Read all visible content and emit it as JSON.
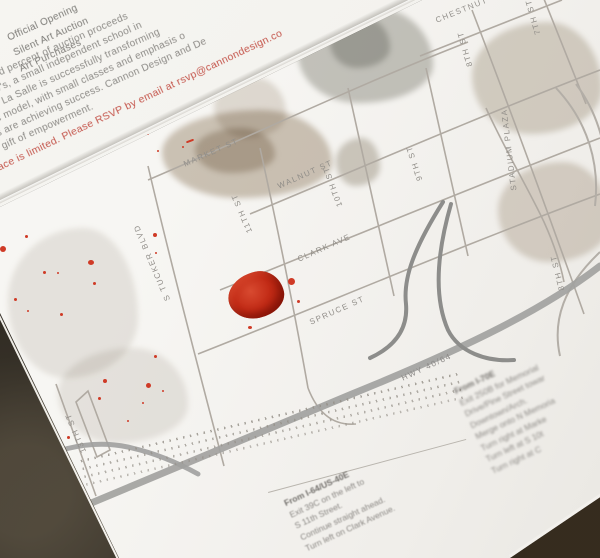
{
  "invitation": {
    "headers": [
      "Official Opening",
      "Silent Art Auction",
      "Art Purchases"
    ],
    "body_lines": [
      "ed percent of auction proceeds",
      "w's, a small independent school in",
      "e La Salle is successfully transforming",
      "ic model, with small classes and emphasis o",
      "ts are achieving success. Cannon Design and De",
      "e gift of empowerment."
    ],
    "rsvp_line": "ace is limited. Please RSVP by email at rsvp@cannondesign.co"
  },
  "map": {
    "street_labels": {
      "chestnut": "CHESTNUT",
      "market": "MARKET ST",
      "walnut": "WALNUT ST",
      "clark": "CLARK AVE",
      "spruce": "SPRUCE ST",
      "hwy": "HWY 40/64",
      "tucker": "S TUCKER BLVD",
      "s13": "13TH ST",
      "s11": "11TH ST",
      "s10": "10TH ST",
      "s9": "9TH ST",
      "s8a": "8TH ST",
      "s7": "7TH ST",
      "s8b": "8TH ST",
      "stadium": "STADIUM PLAZA"
    },
    "marker": "red-ink-blob-location-marker"
  },
  "directions": {
    "from_i64": {
      "heading": "From I-64/US-40E",
      "lines": [
        "Exit 39C on the left to",
        "S 11th Street.",
        "Continue straight ahead.",
        "Turn left on Clark Avenue."
      ]
    },
    "from_i70": {
      "heading": "From I-70E",
      "lines": [
        "Exit 250B for Memorial",
        "Drive/Pine Street towar",
        "Downtown/Arch.",
        "Merge onto N Memoria",
        "Turn right at Marke",
        "Turn left at S 10t",
        "Turn right at C"
      ]
    }
  },
  "colors": {
    "paper": "#f6f5f1",
    "ink_gray": "#8c8a86",
    "accent_red": "#c4544a",
    "splatter_red": "#cf3a26",
    "street_gray": "#b0aaa2",
    "highway_gray": "#a2a2a0",
    "background_dark": "#28241d"
  }
}
